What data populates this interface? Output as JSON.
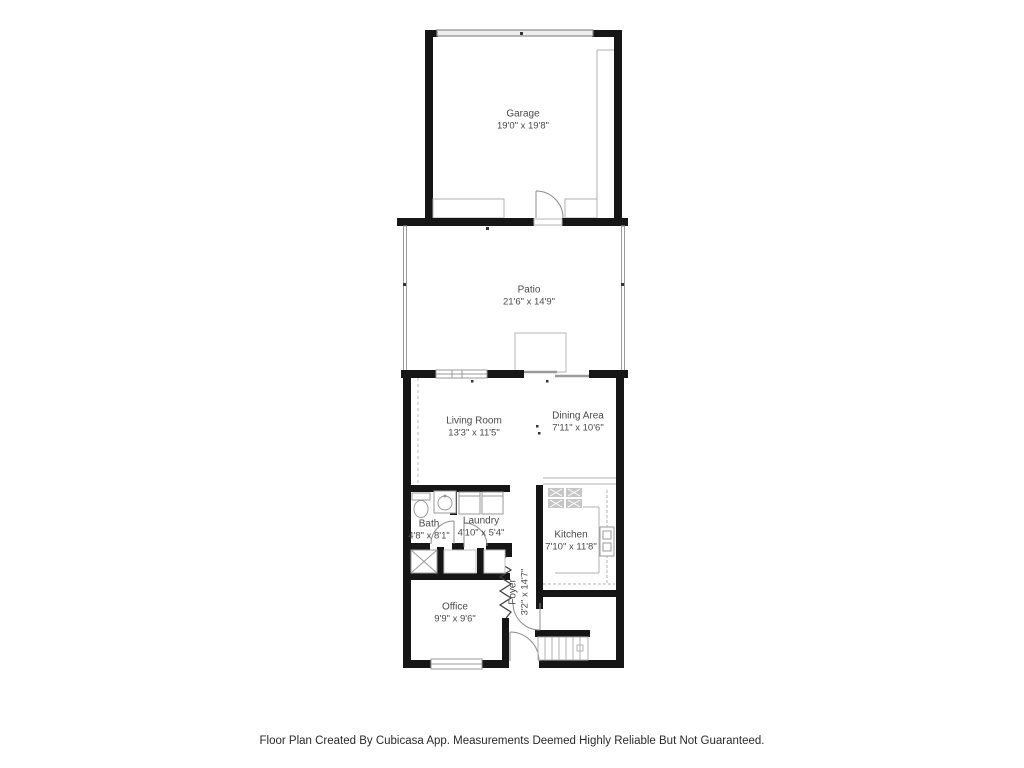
{
  "colors": {
    "wall": "#161616",
    "thin_line": "#9a9a9a",
    "light_line": "#bbbbbb",
    "door_arc": "#8c8c8c",
    "fixture_fill": "#c6c6c6",
    "label_text": "#4a4a4a",
    "footer_text": "#2a2a2a"
  },
  "rooms": [
    {
      "id": "garage",
      "name": "Garage",
      "dims": "19'0\" x 19'8\""
    },
    {
      "id": "patio",
      "name": "Patio",
      "dims": "21'6\" x 14'9\""
    },
    {
      "id": "living-room",
      "name": "Living Room",
      "dims": "13'3\" x 11'5\""
    },
    {
      "id": "dining-area",
      "name": "Dining Area",
      "dims": "7'11\" x 10'6\""
    },
    {
      "id": "bath",
      "name": "Bath",
      "dims": "4'8\" x 8'1\""
    },
    {
      "id": "laundry",
      "name": "Laundry",
      "dims": "4'10\" x 5'4\""
    },
    {
      "id": "kitchen",
      "name": "Kitchen",
      "dims": "7'10\" x 11'8\""
    },
    {
      "id": "foyer",
      "name": "Foyer",
      "dims": "3'2\" x 14'7\""
    },
    {
      "id": "office",
      "name": "Office",
      "dims": "9'9\" x 9'6\""
    }
  ],
  "footer": {
    "disclaimer": "Floor Plan Created By Cubicasa App. Measurements Deemed Highly Reliable But Not Guaranteed."
  }
}
